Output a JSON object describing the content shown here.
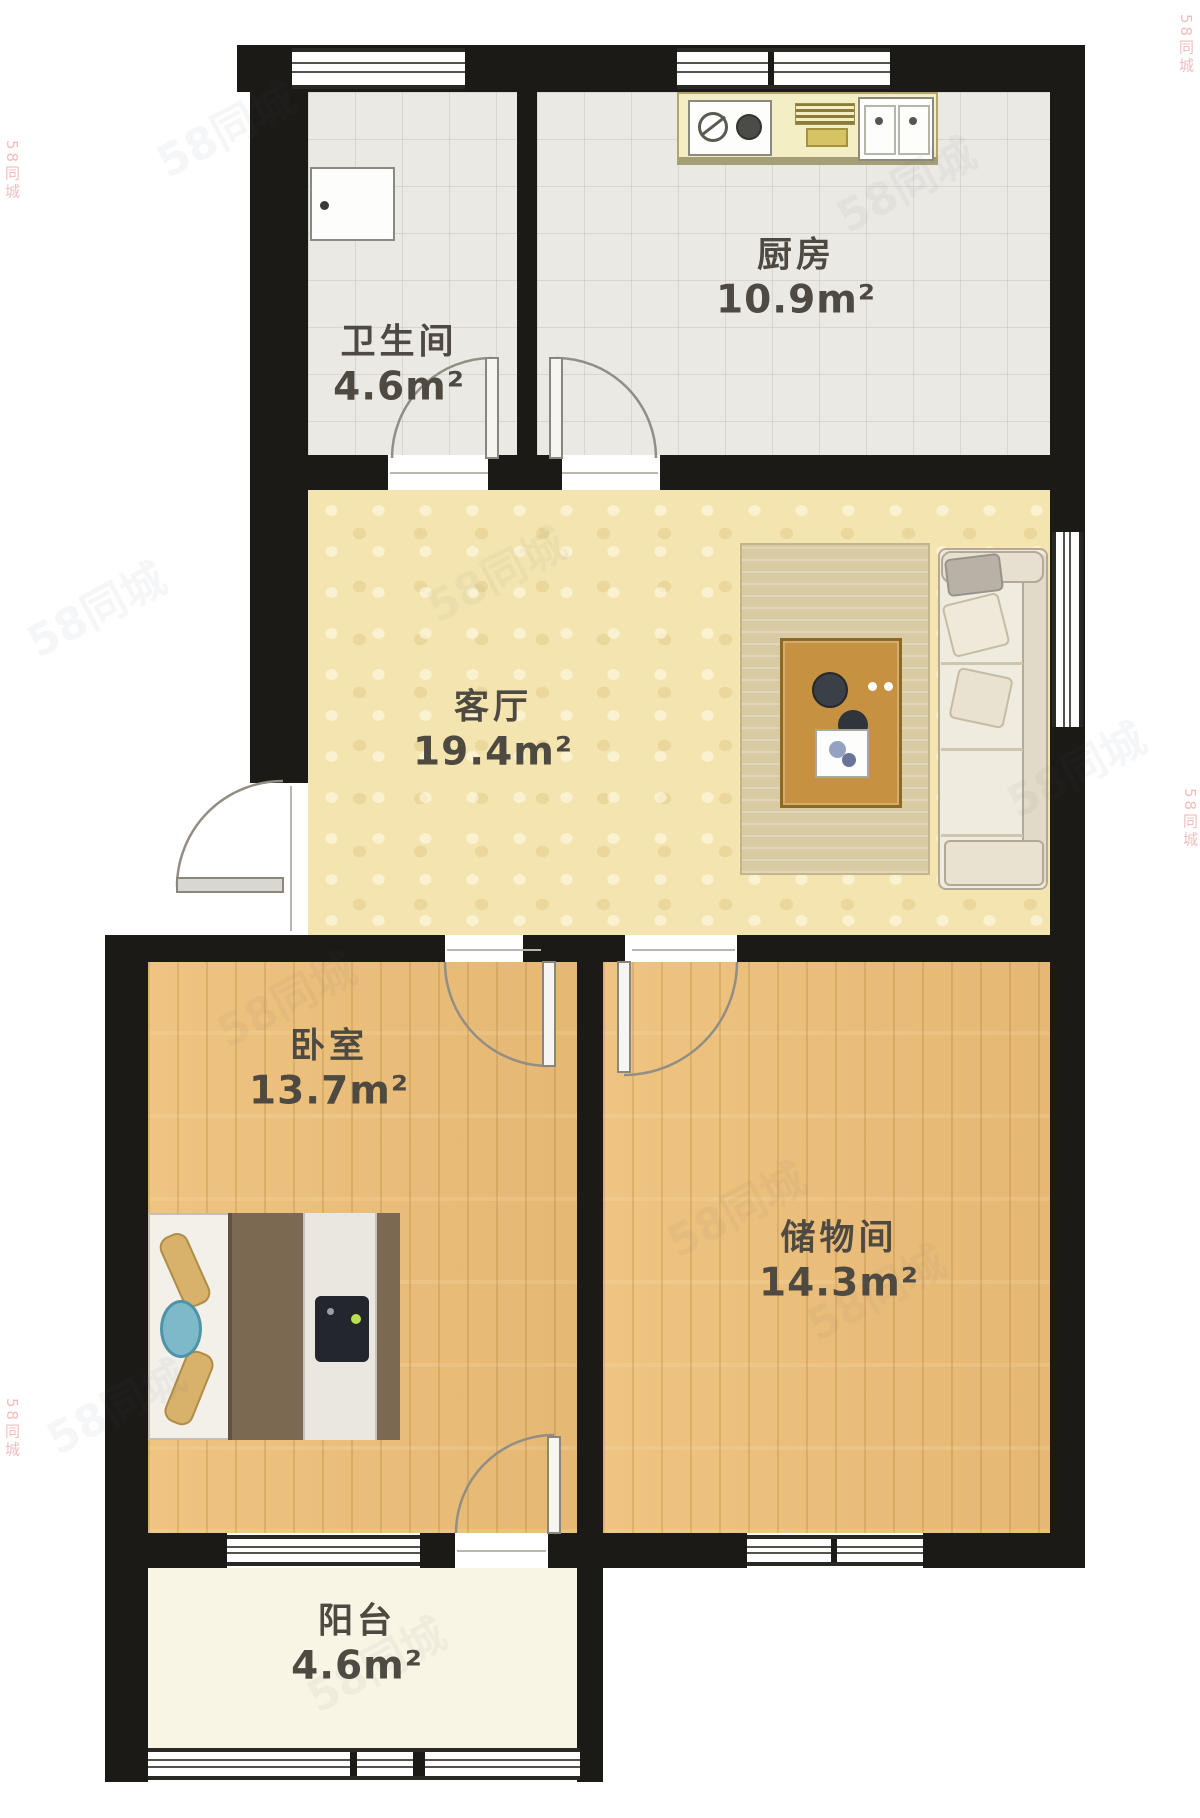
{
  "plan": {
    "watermark": {
      "text": "58同城"
    },
    "rooms": [
      {
        "id": "bathroom",
        "name": "卫生间",
        "area": "4.6m²"
      },
      {
        "id": "kitchen",
        "name": "厨房",
        "area": "10.9m²"
      },
      {
        "id": "living",
        "name": "客厅",
        "area": "19.4m²"
      },
      {
        "id": "bedroom",
        "name": "卧室",
        "area": "13.7m²"
      },
      {
        "id": "storage",
        "name": "储物间",
        "area": "14.3m²"
      },
      {
        "id": "balcony",
        "name": "阳台",
        "area": "4.6m²"
      }
    ],
    "icons": {
      "door": "quarter-circle-swing-arc",
      "window": "multi-line-band",
      "bed": "double-bed-top-view",
      "sofa": "sofa-top-view",
      "coffee-table": "wood-table-top-view",
      "rug": "area-rug",
      "kitchen-counter": "counter-with-sink-and-stove",
      "washbasin": "bathroom-basin",
      "balcony-rail": "railing-band"
    },
    "colors": {
      "wall": "#1c1a17",
      "tile": "#eae9e4",
      "living": "#f4e5b0",
      "wood": "#ecc07c",
      "balcony": "#f8f5e5",
      "counter": "#f4eec5",
      "rug": "#d8cba4",
      "label": "#4e4a42",
      "arc": "#928e83",
      "wm": "#5a6270",
      "wmred": "#e05a5a"
    }
  }
}
